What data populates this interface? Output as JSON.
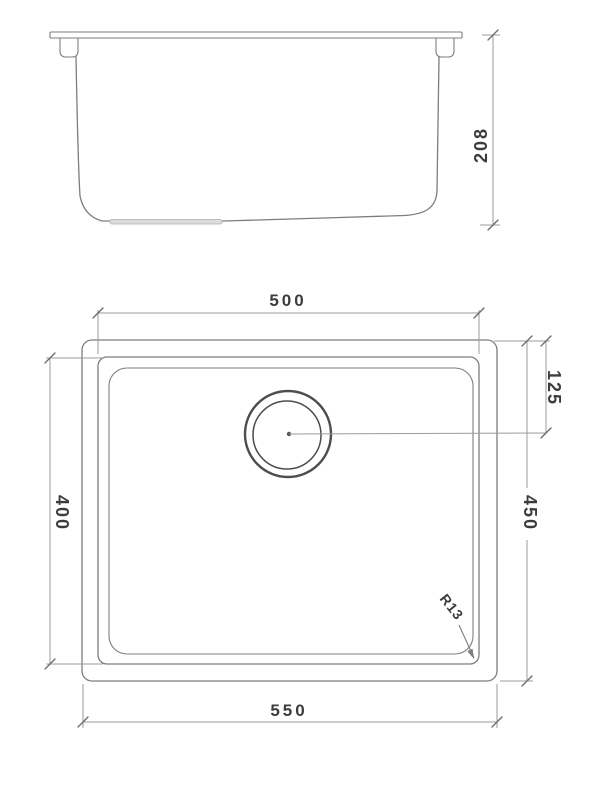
{
  "drawing": {
    "dimensions": {
      "height": "208",
      "bowl_width": "500",
      "drain_center_offset": "125",
      "bowl_depth": "400",
      "overall_depth": "450",
      "corner_radius": "R13",
      "overall_width": "550"
    },
    "colors": {
      "background": "#ffffff",
      "outline": "#7d7d7d",
      "dimline": "#9b9b9b",
      "text": "#3c3c3c",
      "drain": "#4d4d4d"
    }
  }
}
